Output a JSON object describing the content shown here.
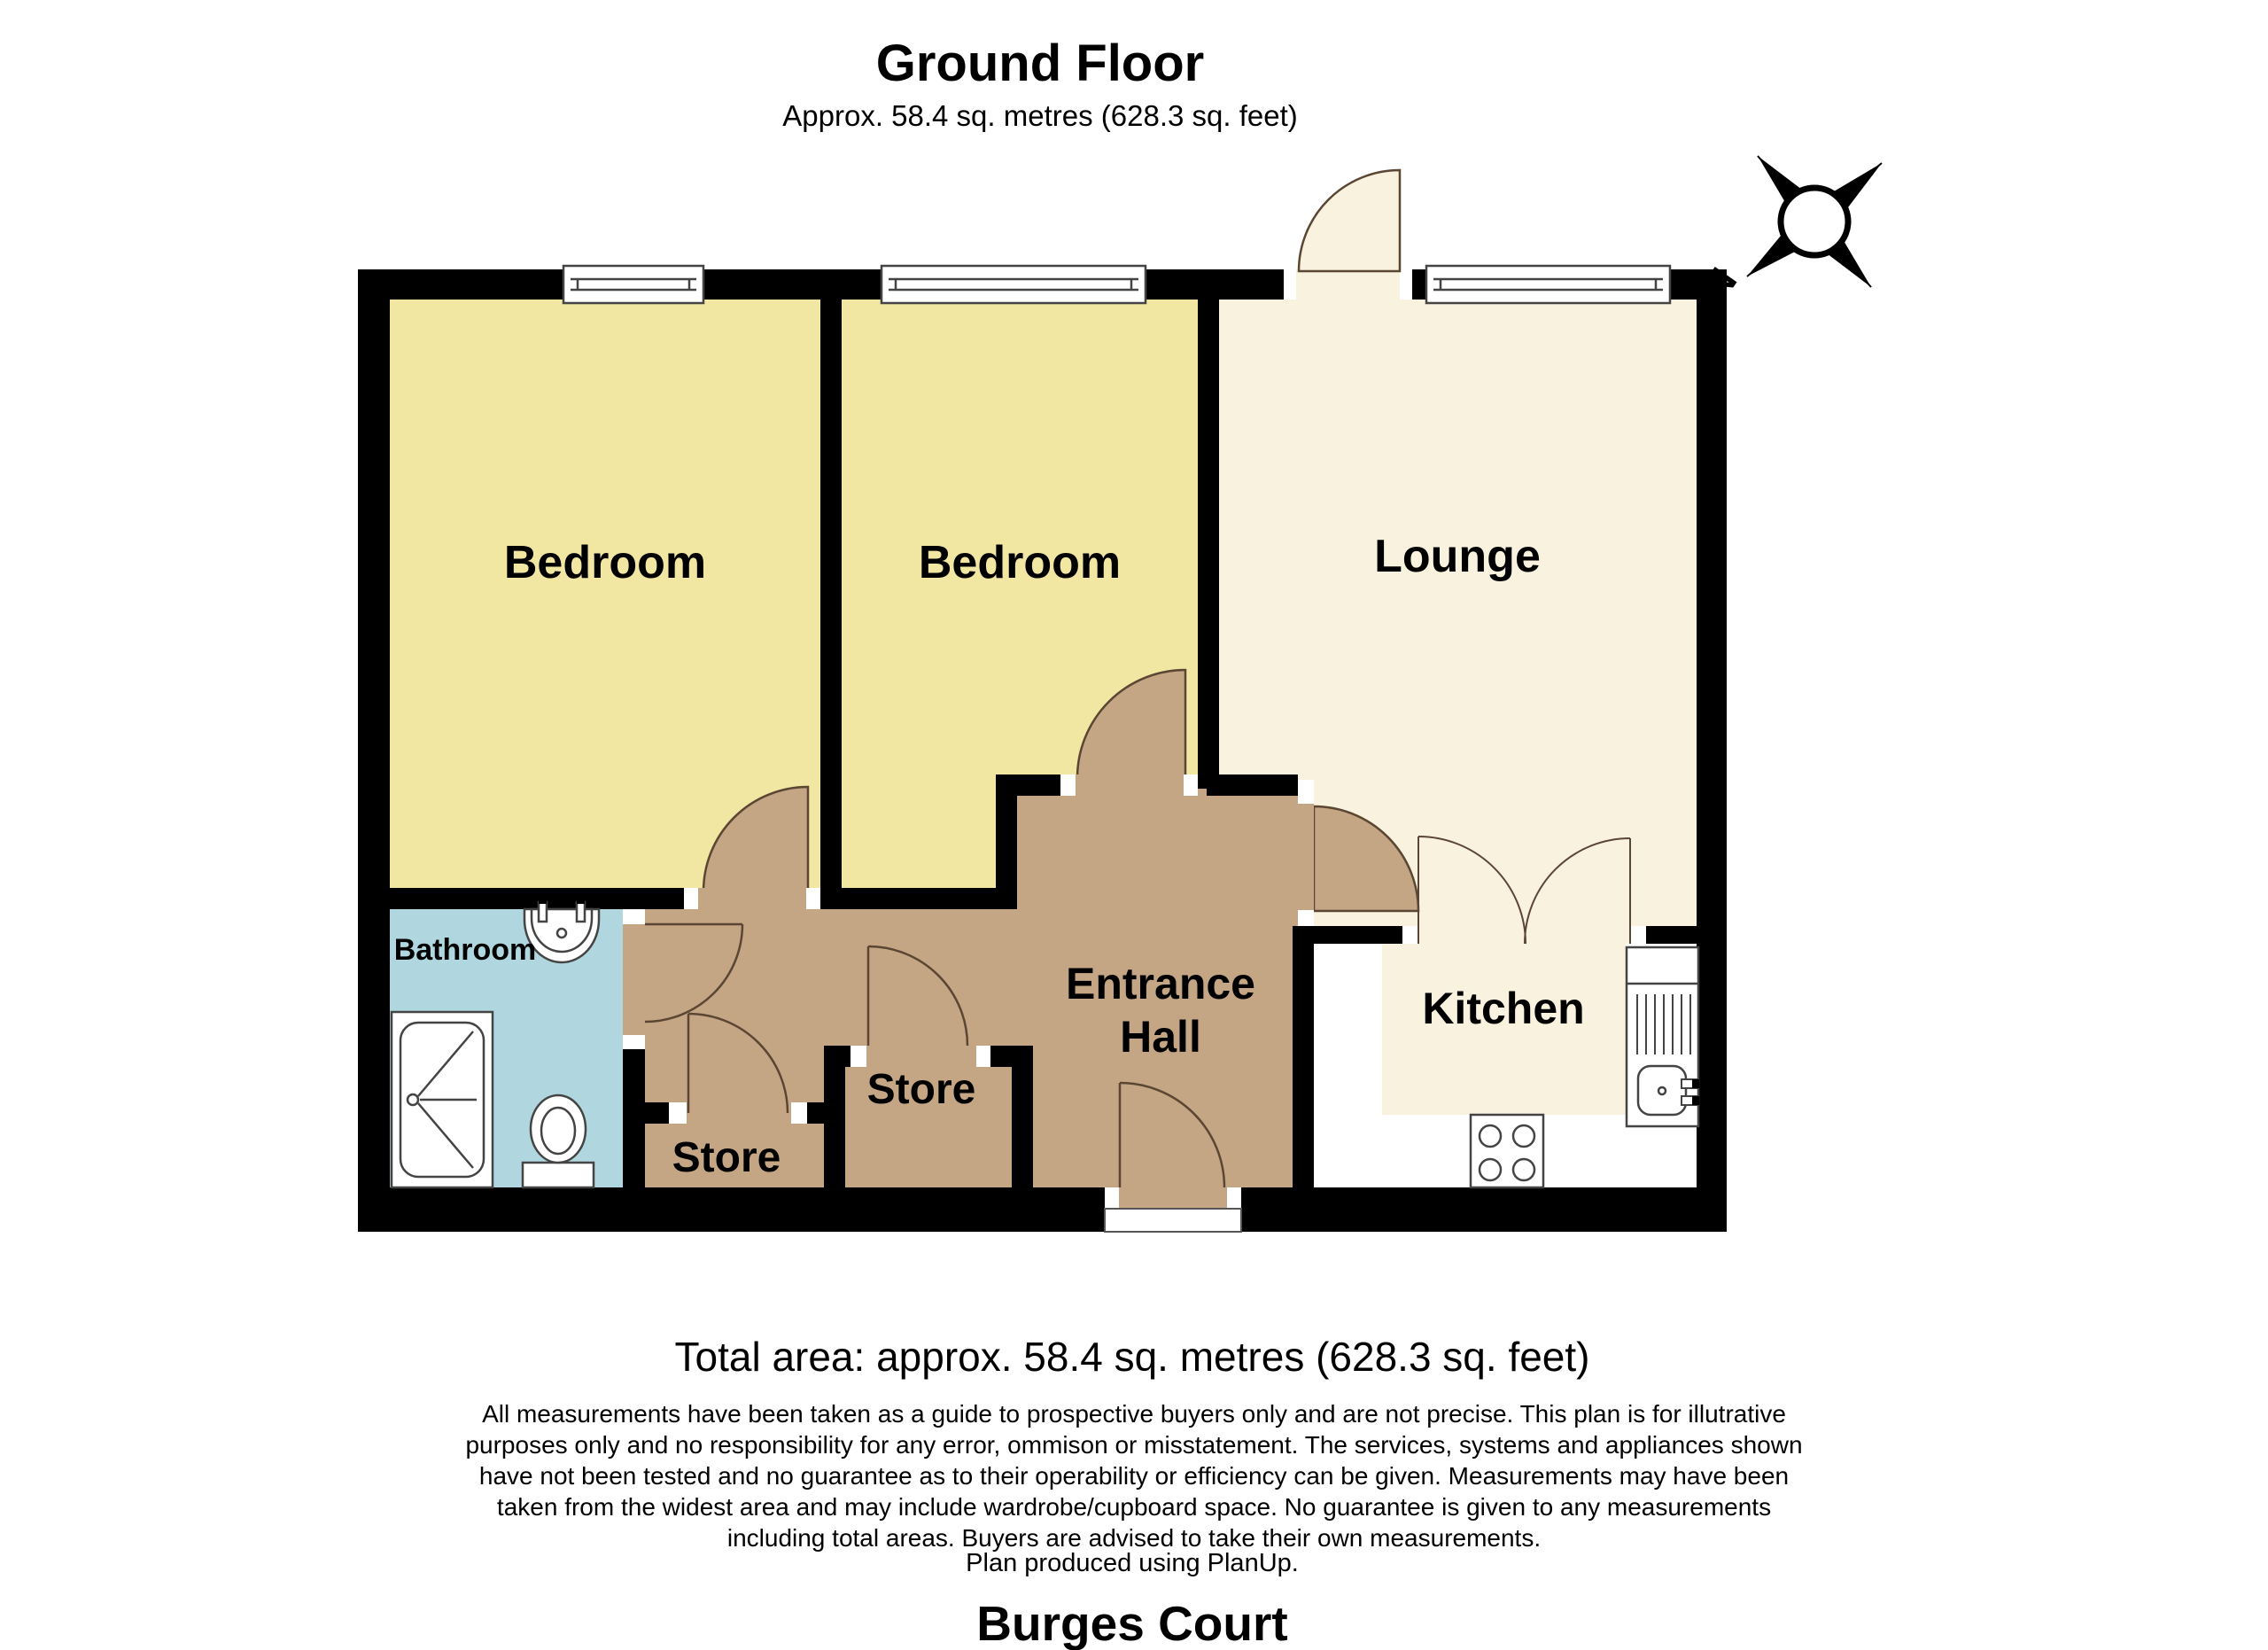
{
  "header": {
    "title": "Ground Floor",
    "subtitle": "Approx. 58.4 sq. metres (628.3 sq. feet)"
  },
  "rooms": {
    "bedroom1": "Bedroom",
    "bedroom2": "Bedroom",
    "lounge": "Lounge",
    "bathroom": "Bathroom",
    "store1": "Store",
    "store2": "Store",
    "entrance_hall_line1": "Entrance",
    "entrance_hall_line2": "Hall",
    "kitchen": "Kitchen"
  },
  "compass": {
    "north_label": "N"
  },
  "footer": {
    "total_area": "Total area: approx. 58.4 sq. metres (628.3 sq. feet)",
    "disclaimer": {
      "line1": "All measurements have been taken as a guide to prospective buyers only and are not precise. This plan is for illutrative",
      "line2": "purposes only and no responsibility for any error, ommison or misstatement. The services, systems and appliances shown",
      "line3": "have not been tested and no guarantee as to their operability or efficiency can be given. Measurements may have been",
      "line4": "taken from the widest area and may include wardrobe/cupboard space. No guarantee is given to any measurements",
      "line5": "including total areas. Buyers are advised to take their own measurements."
    },
    "produced_by": "Plan produced using PlanUp.",
    "property_name": "Burges Court"
  },
  "colors": {
    "bedroom_floor": "#F1E6A2",
    "lounge_kitchen_floor": "#F8F2DE",
    "hall_floor": "#C4A584",
    "bathroom_floor": "#B0D7DF",
    "wall": "#000000",
    "door_arc": "#5A4632",
    "fixture_outline": "#444444"
  }
}
